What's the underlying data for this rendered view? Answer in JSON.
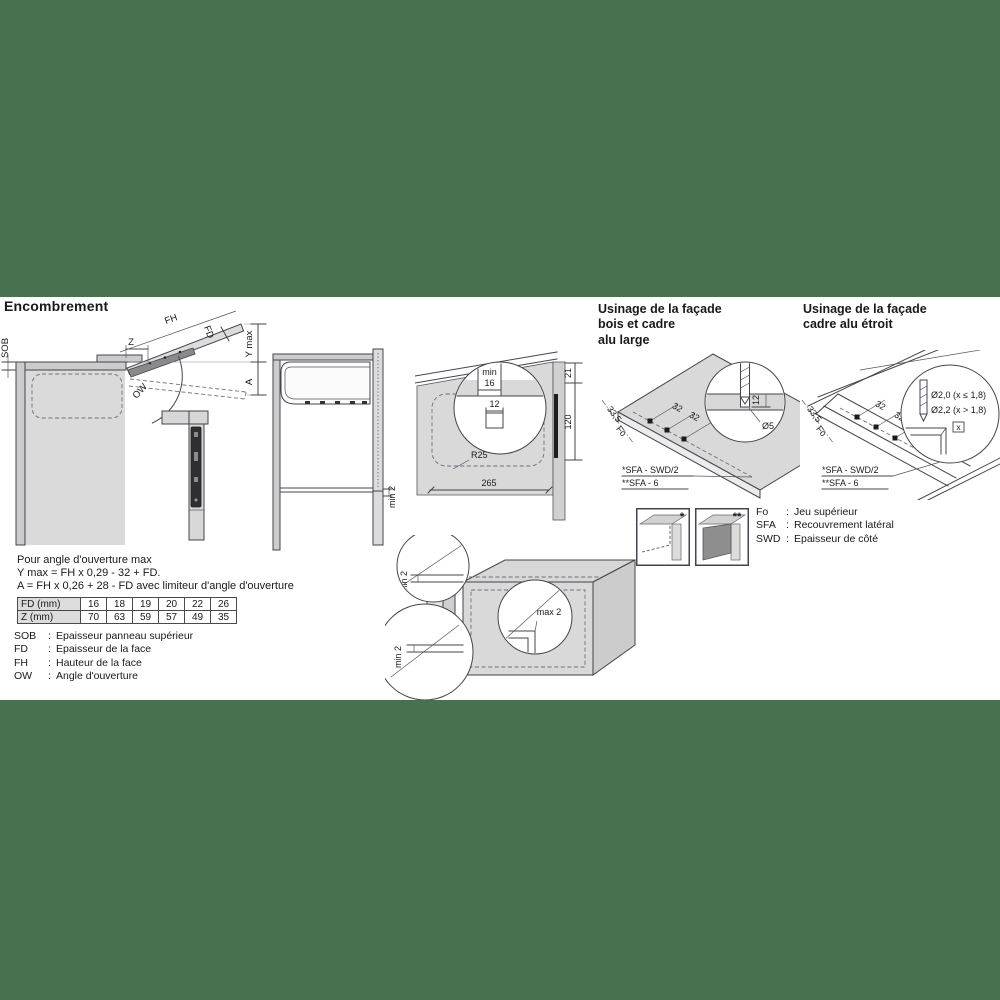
{
  "colors": {
    "band": "#48724F"
  },
  "encombrement": {
    "title": "Encombrement",
    "fh": "FH",
    "fd": "FD",
    "z": "Z",
    "sob": "SOB",
    "ymax": "Y max",
    "a": "A",
    "ow": "OW"
  },
  "side_view": {
    "min2": "min 2"
  },
  "niche": {
    "min": "min",
    "v16": "16",
    "v12": "12",
    "v21": "21",
    "v120": "120",
    "r25": "R25",
    "v265": "265"
  },
  "facade_bois": {
    "title1": "Usinage de la façade",
    "title2": "bois et cadre",
    "title3": "alu large",
    "d335": "33,5",
    "fo": "Fo",
    "d32a": "32",
    "d32b": "32",
    "d12": "12",
    "dia5": "Ø5",
    "note1": "*SFA - SWD/2",
    "note2": "**SFA - 6"
  },
  "facade_alu": {
    "title1": "Usinage de la façade",
    "title2": "cadre alu étroit",
    "d335": "33,5",
    "fo": "Fo",
    "d32a": "32",
    "d32b": "32",
    "dia_small": "Ø2,0 (x ≤ 1,8)",
    "dia_big": "Ø2,2 (x > 1,8)",
    "x": "x",
    "note1": "*SFA - SWD/2",
    "note2": "**SFA - 6"
  },
  "thumbs": {
    "star": "*",
    "dstar": "**"
  },
  "legend_right": {
    "items": [
      {
        "abbr": "Fo",
        "colon": ":",
        "desc": "Jeu supérieur"
      },
      {
        "abbr": "SFA",
        "colon": ":",
        "desc": "Recouvrement latéral"
      },
      {
        "abbr": "SWD",
        "colon": ":",
        "desc": "Epaisseur de côté"
      }
    ]
  },
  "formulas": {
    "l1": "Pour angle d'ouverture max",
    "l2": "Y max = FH x 0,29 - 32 + FD.",
    "l3": "A = FH x 0,26 + 28 - FD avec limiteur d'angle d'ouverture"
  },
  "table": {
    "rows": [
      {
        "label": "FD (mm)",
        "values": [
          "16",
          "18",
          "19",
          "20",
          "22",
          "26"
        ]
      },
      {
        "label": "Z (mm)",
        "values": [
          "70",
          "63",
          "59",
          "57",
          "49",
          "35"
        ]
      }
    ]
  },
  "legend_left": {
    "items": [
      {
        "abbr": "SOB",
        "colon": ":",
        "desc": "Epaisseur panneau supérieur"
      },
      {
        "abbr": "FD",
        "colon": ":",
        "desc": "Epaisseur de la face"
      },
      {
        "abbr": "FH",
        "colon": ":",
        "desc": "Hauteur de la face"
      },
      {
        "abbr": "OW",
        "colon": ":",
        "desc": "Angle d'ouverture"
      }
    ]
  },
  "cabinet_gaps": {
    "min2_top": "min 2",
    "min2_bottom": "min 2",
    "max2": "max 2"
  }
}
